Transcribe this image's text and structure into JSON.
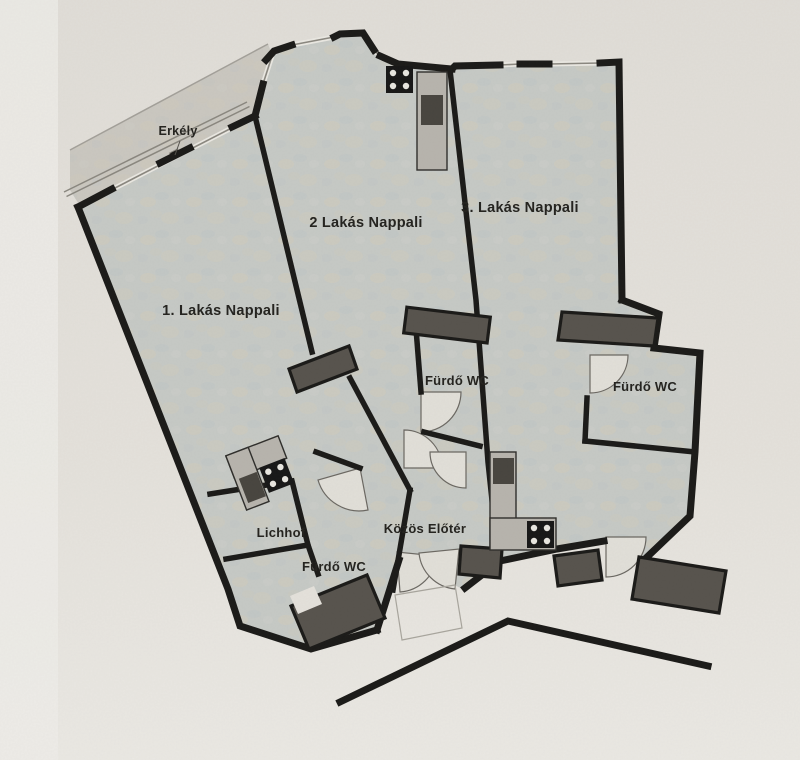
{
  "document": {
    "kind": "scanned apartment floor plan"
  },
  "rooms": {
    "balcony": {
      "label": "Erkély"
    },
    "apt1": {
      "label": "1. Lakás Nappali"
    },
    "apt2": {
      "label": "2 Lakás Nappali"
    },
    "apt3": {
      "label": "3. Lakás Nappali"
    },
    "bath1": {
      "label": "Fürdő WC"
    },
    "bath2": {
      "label": "Fürdő WC"
    },
    "bath3": {
      "label": "Fürdő WC"
    },
    "lichhof": {
      "label": "Lichhof"
    },
    "foyer": {
      "label": "Közös Előtér"
    }
  },
  "colors": {
    "paper": "#e4e1db",
    "paper_light": "#edece8",
    "floor": "#c6c9c5",
    "balcony": "#cac7c0",
    "wall": "#1b1a18",
    "pillar": "#57534d",
    "counter": "#b7b4ad",
    "sink": "#48453f",
    "stove": "#171717",
    "burner": "#e8e6e0",
    "door": "#e1dfd8",
    "door_edge": "#6b6862",
    "window": "#8a877f",
    "window_band": "#eae8e2",
    "text": "#24231f"
  }
}
